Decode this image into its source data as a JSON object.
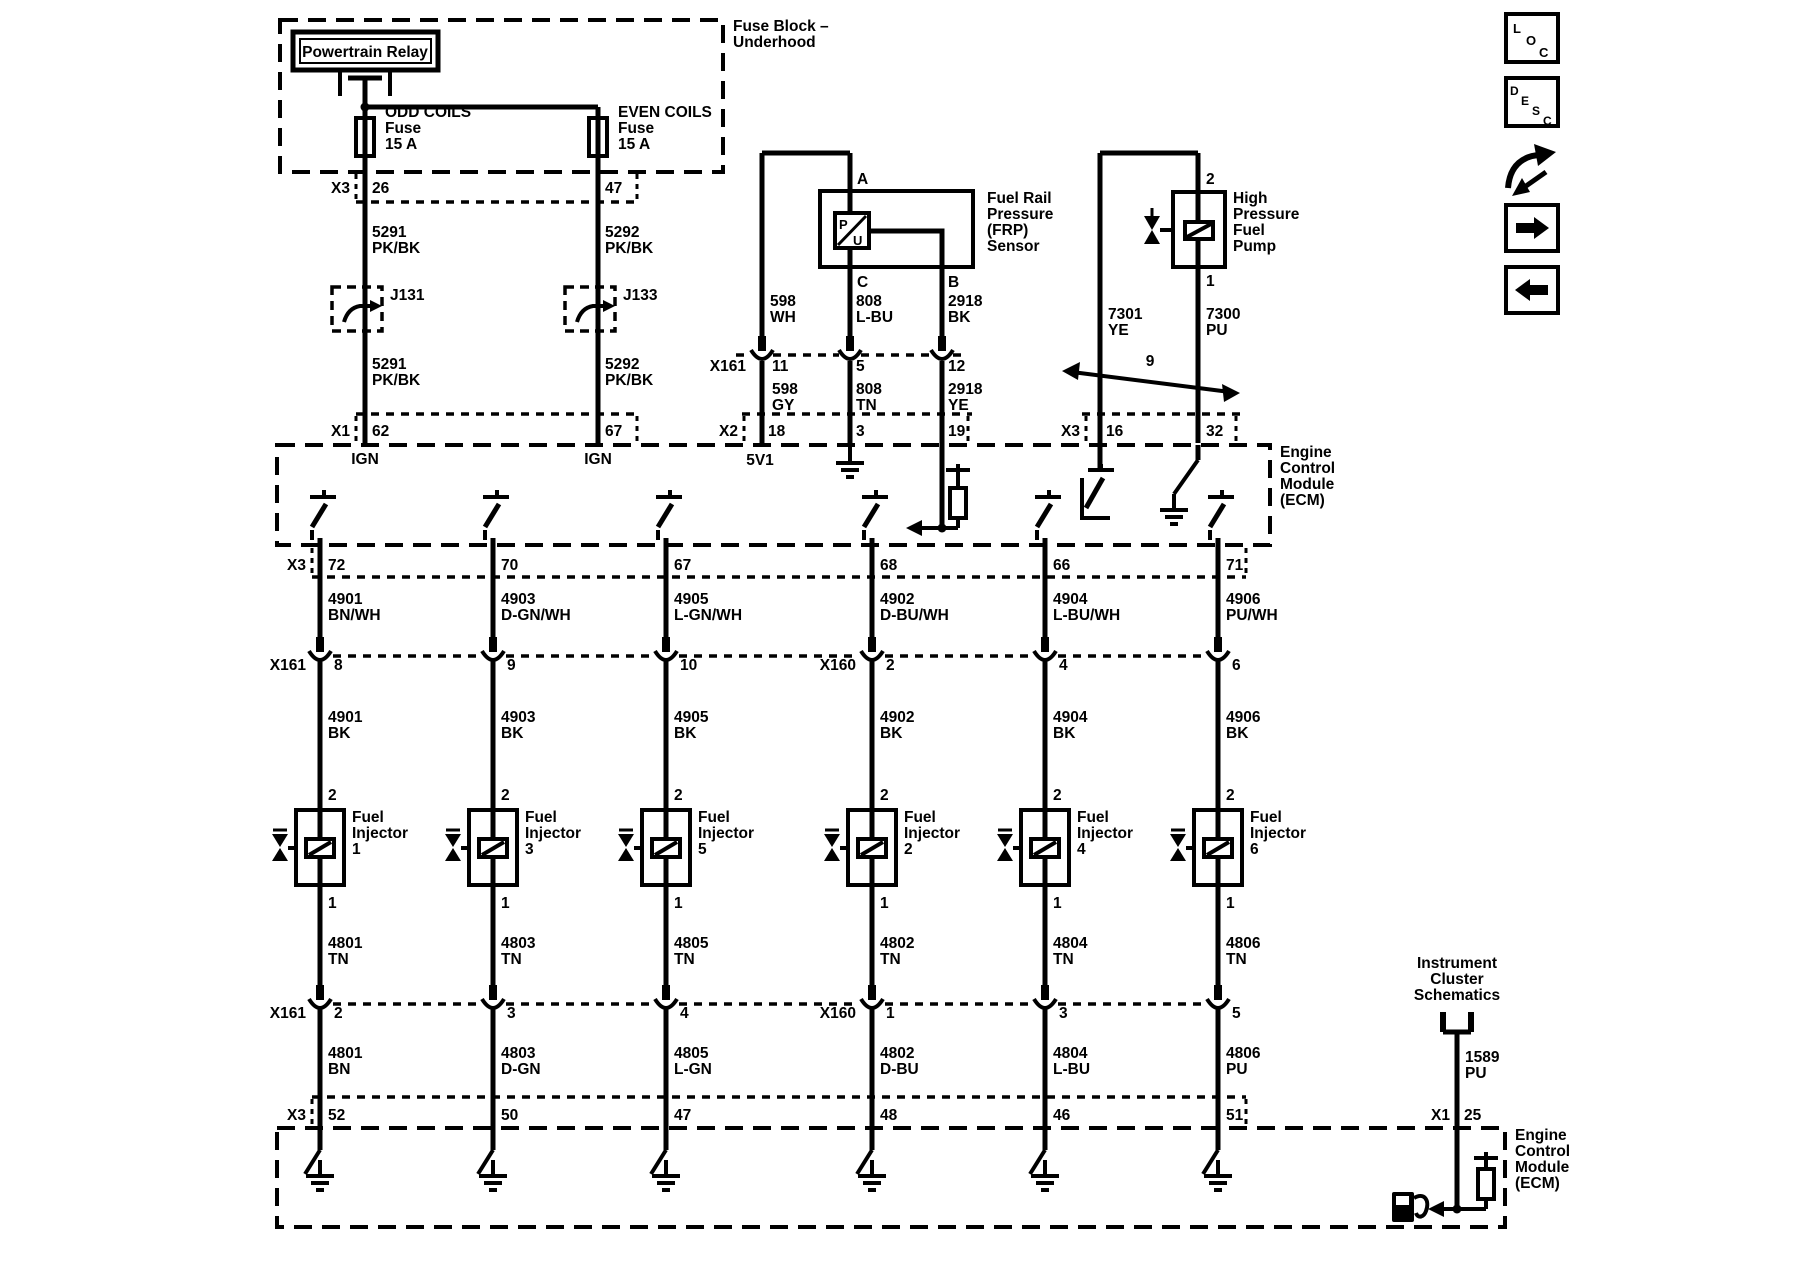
{
  "palette": {
    "ink": "#000000",
    "paper": "#ffffff"
  },
  "sidebar": {
    "loc_letters": [
      "L",
      "O",
      "C"
    ],
    "desc_letters": [
      "D",
      "E",
      "S",
      "C"
    ]
  },
  "fuse_block": {
    "title_l1": "Fuse Block –",
    "title_l2": "Underhood",
    "relay_label": "Powertrain Relay",
    "odd_fuse_l1": "ODD COILS",
    "odd_fuse_l2": "Fuse",
    "odd_fuse_l3": "15 A",
    "even_fuse_l1": "EVEN COILS",
    "even_fuse_l2": "Fuse",
    "even_fuse_l3": "15 A"
  },
  "coil_feed": {
    "x3_name": "X3",
    "x3_odd_pin": "26",
    "x3_even_pin": "47",
    "odd_wire_upper_num": "5291",
    "odd_wire_upper_color": "PK/BK",
    "even_wire_upper_num": "5292",
    "even_wire_upper_color": "PK/BK",
    "odd_splice": "J131",
    "even_splice": "J133",
    "odd_wire_lower_num": "5291",
    "odd_wire_lower_color": "PK/BK",
    "even_wire_lower_num": "5292",
    "even_wire_lower_color": "PK/BK",
    "x1_name": "X1",
    "x1_odd_pin": "62",
    "x1_even_pin": "67",
    "odd_fn": "IGN",
    "even_fn": "IGN"
  },
  "frp_sensor": {
    "title_l1": "Fuel Rail",
    "title_l2": "Pressure",
    "title_l3": "(FRP)",
    "title_l4": "Sensor",
    "pin_a": "A",
    "pin_c": "C",
    "pin_b": "B",
    "sym_p": "P",
    "sym_u": "U",
    "wire_a_num": "598",
    "wire_a_color": "WH",
    "wire_c_num": "808",
    "wire_c_color": "L-BU",
    "wire_b_num": "2918",
    "wire_b_color": "BK",
    "x161_name": "X161",
    "x161_pin_a": "11",
    "x161_pin_c": "5",
    "x161_pin_b": "12",
    "wire_a2_num": "598",
    "wire_a2_color": "GY",
    "wire_c2_num": "808",
    "wire_c2_color": "TN",
    "wire_b2_num": "2918",
    "wire_b2_color": "YE",
    "x2_name": "X2",
    "x2_pin_a": "18",
    "x2_pin_c": "3",
    "x2_pin_b": "19",
    "ref_5v": "5V1"
  },
  "fuel_pump": {
    "title_l1": "High",
    "title_l2": "Pressure",
    "title_l3": "Fuel",
    "title_l4": "Pump",
    "pin_top": "2",
    "pin_bottom": "1",
    "wire_l_num": "7301",
    "wire_l_color": "YE",
    "wire_r_num": "7300",
    "wire_r_color": "PU",
    "crossover_ref": "9",
    "x3_name": "X3",
    "x3_pin_l": "16",
    "x3_pin_r": "32"
  },
  "ecm_top": {
    "label_l1": "Engine",
    "label_l2": "Control",
    "label_l3": "Module",
    "label_l4": "(ECM)"
  },
  "ecm_bottom": {
    "label_l1": "Engine",
    "label_l2": "Control",
    "label_l3": "Module",
    "label_l4": "(ECM)"
  },
  "injectors": {
    "x3_top": "X3",
    "x3_bottom": "X3",
    "conn_mid_left": "X161",
    "conn_mid_right": "X160",
    "conn_low_left": "X161",
    "conn_low_right": "X160",
    "columns": [
      {
        "ecm_pin": "72",
        "wire_top_num": "4901",
        "wire_top_color": "BN/WH",
        "mid_pin": "8",
        "wire_upper_num": "4901",
        "wire_upper_color": "BK",
        "pin_top": "2",
        "name_l1": "Fuel",
        "name_l2": "Injector",
        "name_l3": "1",
        "pin_bottom": "1",
        "wire_lower_num": "4801",
        "wire_lower_color": "TN",
        "low_pin": "2",
        "wire_bottom_num": "4801",
        "wire_bottom_color": "BN",
        "x3_pin": "52"
      },
      {
        "ecm_pin": "70",
        "wire_top_num": "4903",
        "wire_top_color": "D-GN/WH",
        "mid_pin": "9",
        "wire_upper_num": "4903",
        "wire_upper_color": "BK",
        "pin_top": "2",
        "name_l1": "Fuel",
        "name_l2": "Injector",
        "name_l3": "3",
        "pin_bottom": "1",
        "wire_lower_num": "4803",
        "wire_lower_color": "TN",
        "low_pin": "3",
        "wire_bottom_num": "4803",
        "wire_bottom_color": "D-GN",
        "x3_pin": "50"
      },
      {
        "ecm_pin": "67",
        "wire_top_num": "4905",
        "wire_top_color": "L-GN/WH",
        "mid_pin": "10",
        "wire_upper_num": "4905",
        "wire_upper_color": "BK",
        "pin_top": "2",
        "name_l1": "Fuel",
        "name_l2": "Injector",
        "name_l3": "5",
        "pin_bottom": "1",
        "wire_lower_num": "4805",
        "wire_lower_color": "TN",
        "low_pin": "4",
        "wire_bottom_num": "4805",
        "wire_bottom_color": "L-GN",
        "x3_pin": "47"
      },
      {
        "ecm_pin": "68",
        "wire_top_num": "4902",
        "wire_top_color": "D-BU/WH",
        "mid_pin": "2",
        "wire_upper_num": "4902",
        "wire_upper_color": "BK",
        "pin_top": "2",
        "name_l1": "Fuel",
        "name_l2": "Injector",
        "name_l3": "2",
        "pin_bottom": "1",
        "wire_lower_num": "4802",
        "wire_lower_color": "TN",
        "low_pin": "1",
        "wire_bottom_num": "4802",
        "wire_bottom_color": "D-BU",
        "x3_pin": "48"
      },
      {
        "ecm_pin": "66",
        "wire_top_num": "4904",
        "wire_top_color": "L-BU/WH",
        "mid_pin": "4",
        "wire_upper_num": "4904",
        "wire_upper_color": "BK",
        "pin_top": "2",
        "name_l1": "Fuel",
        "name_l2": "Injector",
        "name_l3": "4",
        "pin_bottom": "1",
        "wire_lower_num": "4804",
        "wire_lower_color": "TN",
        "low_pin": "3",
        "wire_bottom_num": "4804",
        "wire_bottom_color": "L-BU",
        "x3_pin": "46"
      },
      {
        "ecm_pin": "71",
        "wire_top_num": "4906",
        "wire_top_color": "PU/WH",
        "mid_pin": "6",
        "wire_upper_num": "4906",
        "wire_upper_color": "BK",
        "pin_top": "2",
        "name_l1": "Fuel",
        "name_l2": "Injector",
        "name_l3": "6",
        "pin_bottom": "1",
        "wire_lower_num": "4806",
        "wire_lower_color": "TN",
        "low_pin": "5",
        "wire_bottom_num": "4806",
        "wire_bottom_color": "PU",
        "x3_pin": "51"
      }
    ]
  },
  "instrument_cluster": {
    "title_l1": "Instrument",
    "title_l2": "Cluster",
    "title_l3": "Schematics",
    "wire_num": "1589",
    "wire_color": "PU",
    "x1_name": "X1",
    "x1_pin": "25"
  }
}
